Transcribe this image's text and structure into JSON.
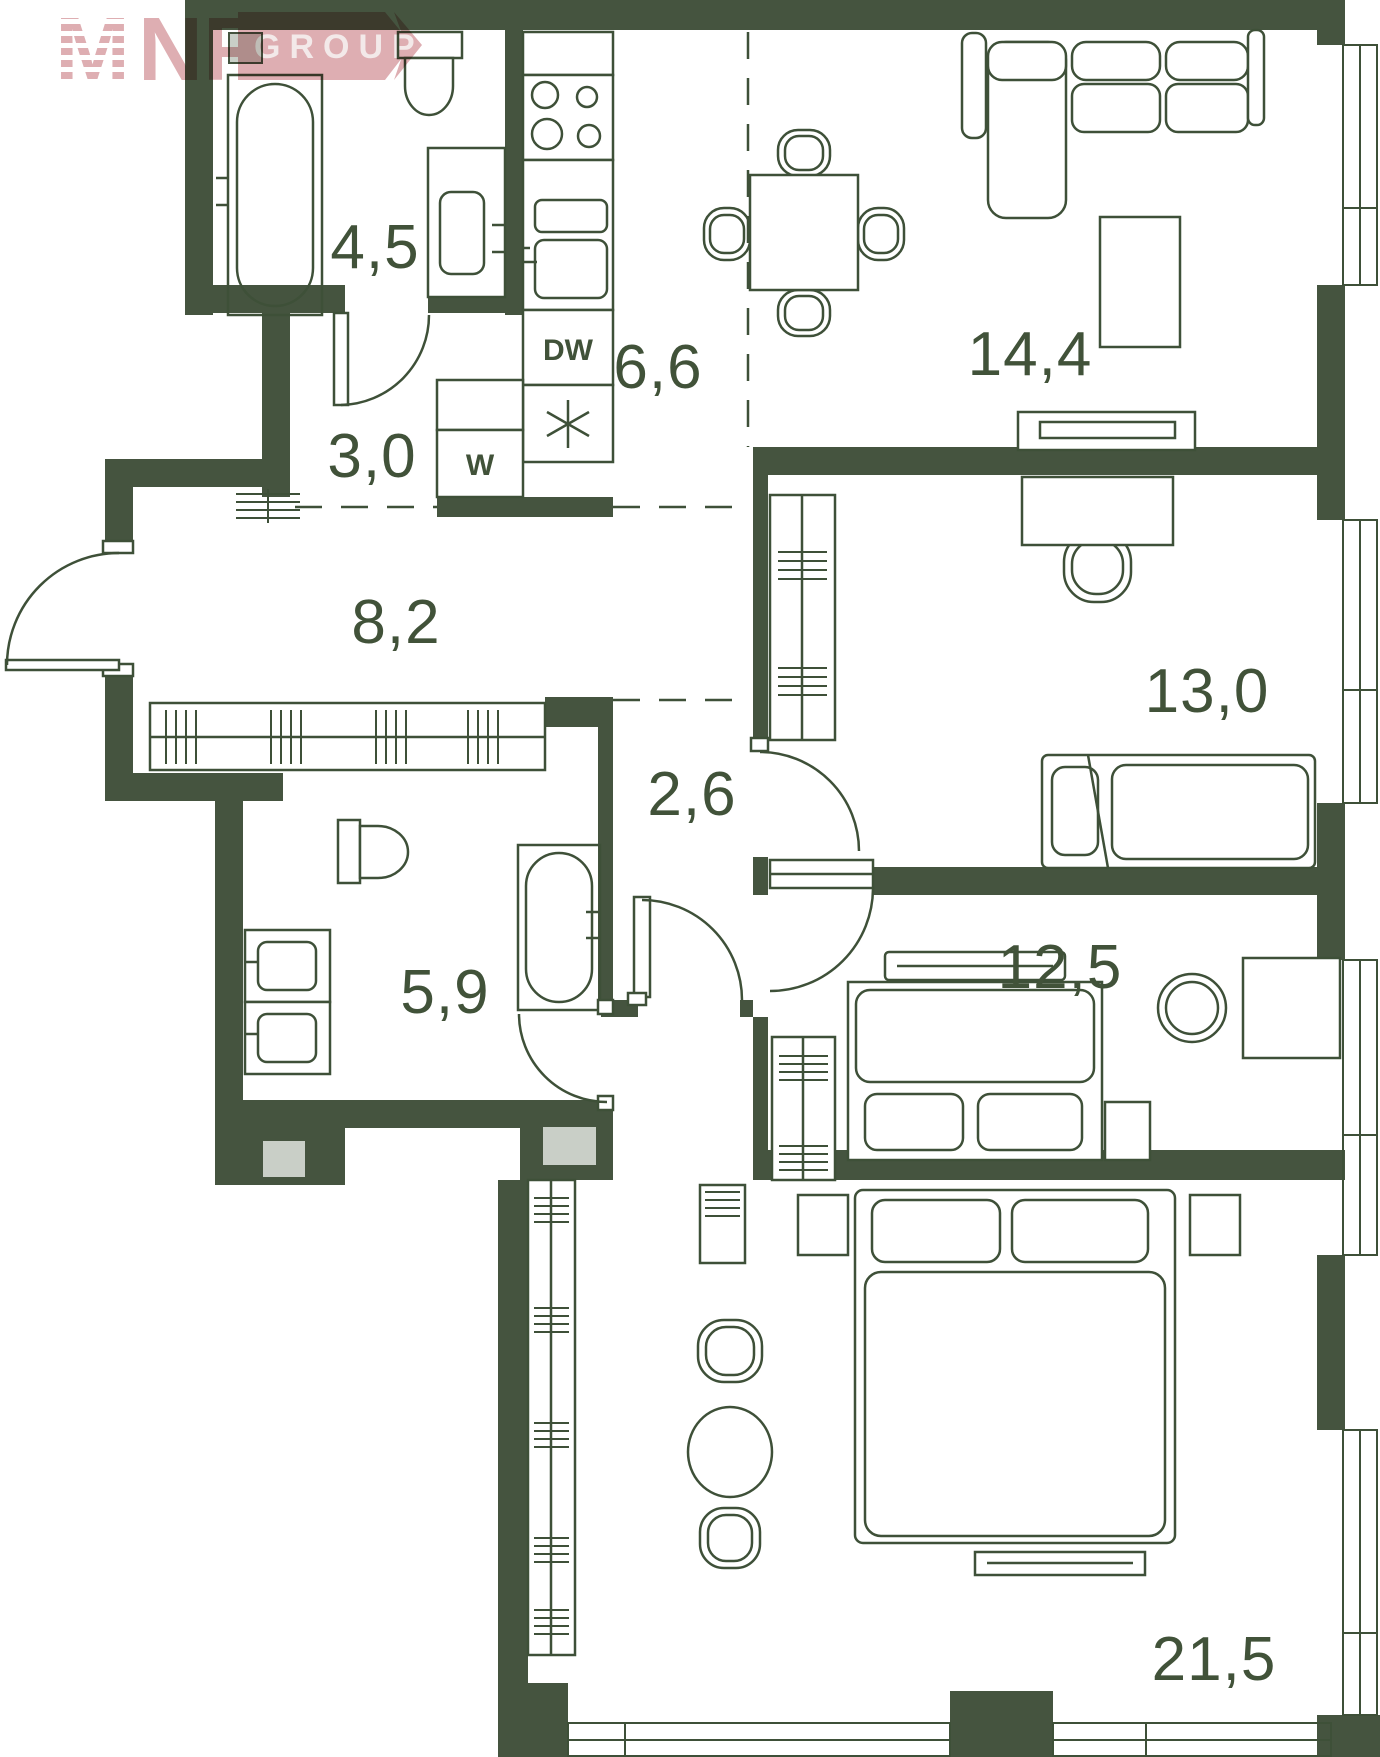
{
  "plan": {
    "watermark": {
      "logo_m": "M",
      "logo_nf": "NF",
      "band": "GROUP"
    },
    "appliances": {
      "dishwasher": "DW",
      "washer": "W"
    },
    "rooms": [
      {
        "id": "bathroom-1",
        "area": "4,5"
      },
      {
        "id": "hallway-1",
        "area": "3,0"
      },
      {
        "id": "kitchen",
        "area": "6,6"
      },
      {
        "id": "living-room",
        "area": "14,4"
      },
      {
        "id": "entry-hall",
        "area": "8,2"
      },
      {
        "id": "bedroom-1",
        "area": "13,0"
      },
      {
        "id": "hallway-2",
        "area": "2,6"
      },
      {
        "id": "bathroom-2",
        "area": "5,9"
      },
      {
        "id": "bedroom-2",
        "area": "12,5"
      },
      {
        "id": "bedroom-3",
        "area": "21,5"
      }
    ],
    "colors": {
      "wall": "#45543F",
      "line": "#3E5038",
      "text": "#415239",
      "shaft": "#C9CFC7",
      "watermark_pink": "#DBA7AC",
      "watermark_text": "#F2E7E7"
    }
  }
}
